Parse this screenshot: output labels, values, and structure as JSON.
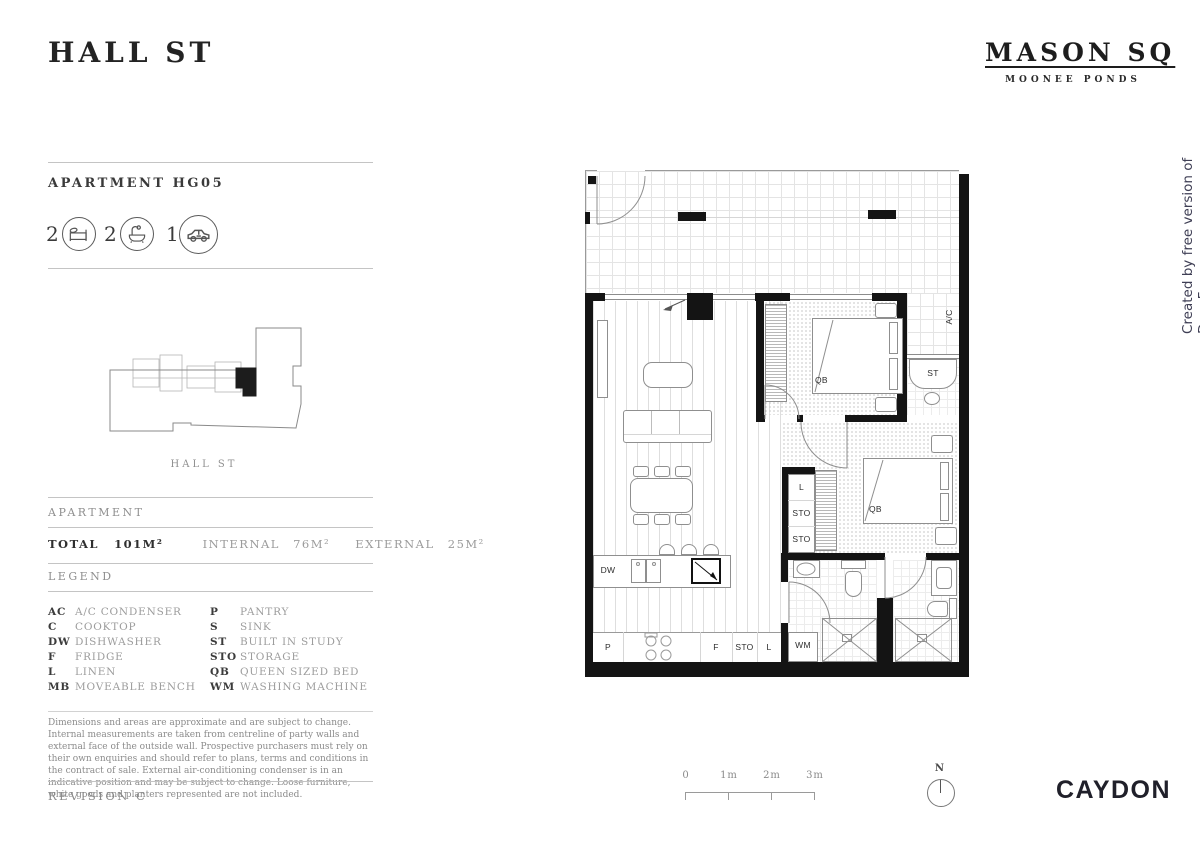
{
  "header": {
    "title": "HALL ST"
  },
  "brand": {
    "name": "MASON SQ",
    "location": "MOONEE PONDS"
  },
  "watermark": "Created by free version of DocuFreezer",
  "apartment": {
    "label": "APARTMENT HG05",
    "stats": {
      "bedrooms": "2",
      "bathrooms": "2",
      "carparks": "1"
    }
  },
  "keyplan": {
    "street": "HALL ST"
  },
  "areas": {
    "section": "APARTMENT",
    "total_label": "TOTAL",
    "total_value": "101M²",
    "internal_label": "INTERNAL",
    "internal_value": "76M²",
    "external_label": "EXTERNAL",
    "external_value": "25M²"
  },
  "legend": {
    "section": "LEGEND",
    "left": [
      {
        "code": "AC",
        "label": "A/C CONDENSER"
      },
      {
        "code": "C",
        "label": "COOKTOP"
      },
      {
        "code": "DW",
        "label": "DISHWASHER"
      },
      {
        "code": "F",
        "label": "FRIDGE"
      },
      {
        "code": "L",
        "label": "LINEN"
      },
      {
        "code": "MB",
        "label": "MOVEABLE BENCH"
      }
    ],
    "right": [
      {
        "code": "P",
        "label": "PANTRY"
      },
      {
        "code": "S",
        "label": "SINK"
      },
      {
        "code": "ST",
        "label": "BUILT IN STUDY"
      },
      {
        "code": "STO",
        "label": "STORAGE"
      },
      {
        "code": "QB",
        "label": "QUEEN SIZED BED"
      },
      {
        "code": "WM",
        "label": "WASHING MACHINE"
      }
    ]
  },
  "disclaimer": "Dimensions and areas are approximate and are subject to change. Internal measurements are taken from centreline of party walls and external face of the outside wall. Prospective purchasers must rely on their own enquiries and should refer to plans, terms and conditions in the contract of sale. External air-conditioning condenser is in an indicative position and may be subject to change. Loose furniture, white goods and planters represented are not included.",
  "revision": "REVISION C",
  "plan": {
    "labels": {
      "ac": "A/C",
      "st": "ST",
      "qb1": "QB",
      "qb2": "QB",
      "linen": "L",
      "sto1": "STO",
      "sto2": "STO",
      "dw": "DW",
      "pantry": "P",
      "fridge": "F",
      "sto3": "STO",
      "linen2": "L",
      "wm": "WM"
    }
  },
  "scalebar": {
    "t0": "0",
    "t1": "1m",
    "t2": "2m",
    "t3": "3m"
  },
  "north": {
    "label": "N"
  },
  "developer": {
    "logo": "CAYDON"
  }
}
